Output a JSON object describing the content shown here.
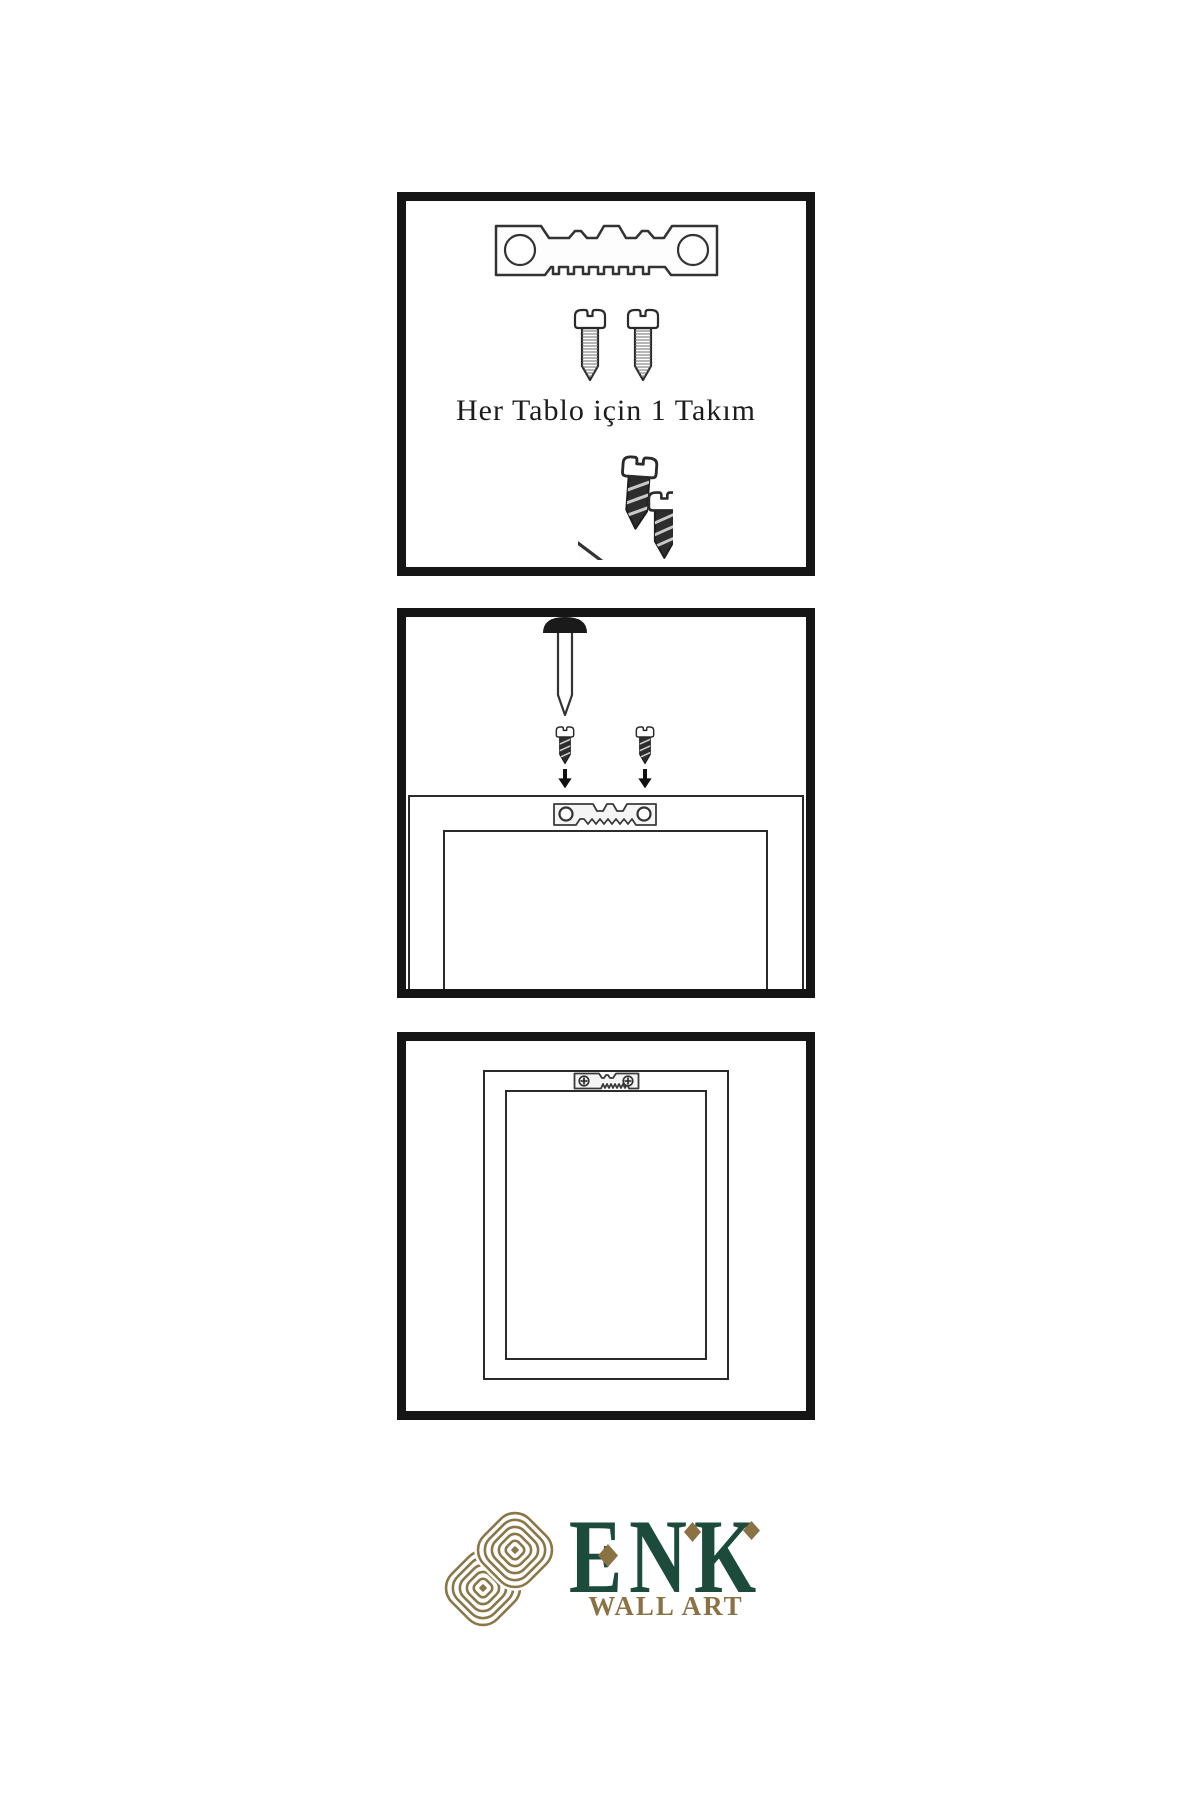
{
  "step1": {
    "caption": "Her Tablo için 1 Takım"
  },
  "brand": {
    "name": "ENK",
    "subtitle": "WALL ART",
    "colors": {
      "green": "#1d4b3b",
      "gold": "#8b7245",
      "knot_gold": "#8a7748",
      "panel_border": "#151515",
      "line": "#2b2b2b"
    }
  },
  "icons": {
    "hanger": "sawtooth-hanger-icon",
    "screw": "screw-icon",
    "nail": "nail-icon",
    "arrow": "down-arrow-icon",
    "frame": "picture-frame-icon",
    "knot": "knot-logo-icon",
    "diamond": "diamond-accent-icon"
  }
}
